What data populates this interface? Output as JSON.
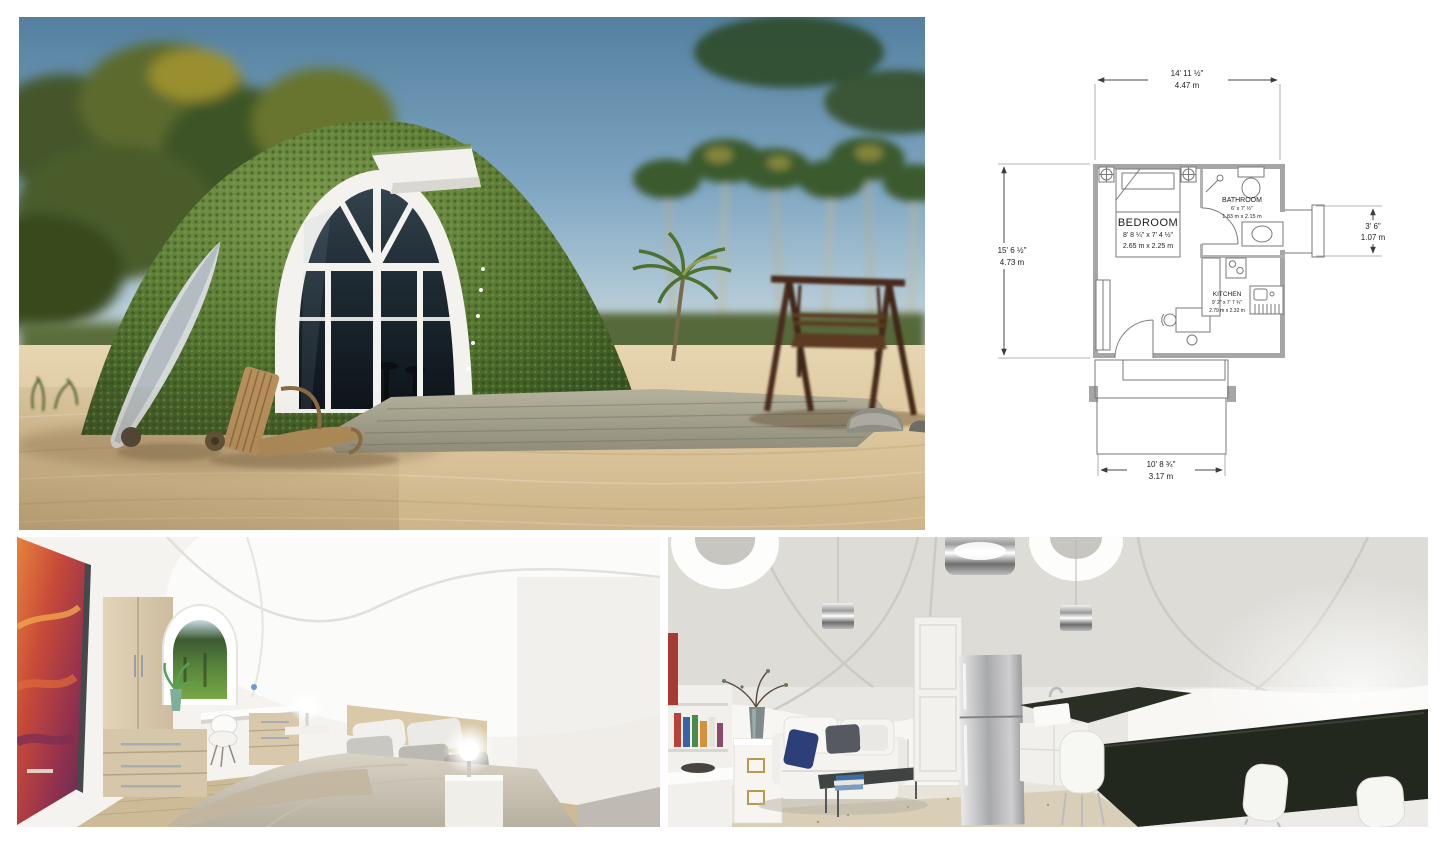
{
  "page": {
    "background": "#ffffff"
  },
  "photos": {
    "exterior": {
      "label": "green-roof dome home on beach render"
    },
    "bedroom": {
      "label": "dome bedroom interior render"
    },
    "living": {
      "label": "dome living room and kitchen interior render"
    }
  },
  "floor_plan": {
    "rooms": {
      "bedroom": {
        "name": "BEDROOM",
        "imperial": "8' 8 ¼\" x 7' 4 ½\"",
        "metric": "2.65 m x 2.25 m"
      },
      "bathroom": {
        "name": "BATHROOM",
        "imperial": "6' x 7' ½\"",
        "metric": "1.83 m x 2.15 m"
      },
      "kitchen": {
        "name": "KITCHEN",
        "imperial": "9' 2\" x 7' 7 ¾\"",
        "metric": "2.79 m x 2.32 m"
      }
    },
    "dimensions": {
      "width_top": {
        "imperial": "14' 11 ½\"",
        "metric": "4.47 m"
      },
      "height_left": {
        "imperial": "15' 6 ½\"",
        "metric": "4.73 m"
      },
      "entry_right": {
        "imperial": "3' 6\"",
        "metric": "1.07 m"
      },
      "porch_bottom": {
        "imperial": "10' 8 ¾\"",
        "metric": "3.17 m"
      }
    },
    "colors": {
      "wall": "#a6a6a6",
      "line": "#4a4a4a",
      "text": "#1d1d1d"
    }
  }
}
